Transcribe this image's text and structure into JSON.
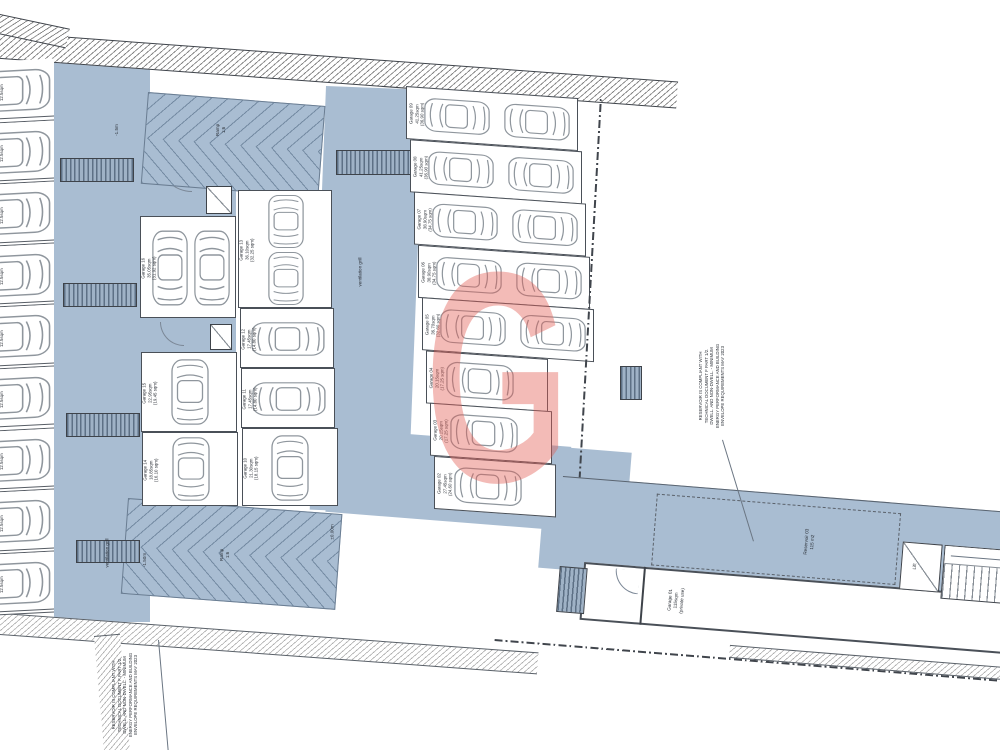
{
  "drawing": {
    "type": "basement garage floor plan"
  },
  "colors": {
    "floor_blue": "#a9bdd2",
    "watermark_red": "#e25e53",
    "wall_dark": "#3e434a"
  },
  "watermark": {
    "letter": "G"
  },
  "labels": {
    "ramp_top": "Ramp\n1:6",
    "ramp_bottom": "Ramp\n1:6",
    "level_top": "-1.5m",
    "level_bottom_left": "-1.50m",
    "level_bottom_right": "±0.00m",
    "vent_mid": "ventilation grill",
    "vent_bottom": "ventilation grill",
    "lift": "Lift",
    "reservoir": "Reservoir 03\n115 m2",
    "garage01": "Garage 01\n115sqm\n(private use)",
    "note_left": "RESERVOIR IS COMPLIANT WITH\nTECHNICAL DOCUMENT F PART 1/2.\nDWELL. AND NON-DWELL. - MINIMUM\nENERGY PERFORMANCE AND BUILDING\nENVELOPE REQUIREMENTS MAY 2023",
    "note_right": "RESERVOIR IS COMPLIANT WITH\nTECHNICAL DOCUMENT F PART 1/2.\nDWELL. AND NON-DWELL. - MINIMUM\nENERGY PERFORMANCE AND BUILDING\nENVELOPE REQUIREMENTS MAY 2023"
  },
  "left_stalls": [
    {
      "name": "Garage 17",
      "area": "12.5sqm"
    },
    {
      "name": "Garage 18",
      "area": "12.5sqm"
    },
    {
      "name": "Garage 19",
      "area": "12.5sqm"
    },
    {
      "name": "Garage 20",
      "area": "12.5sqm"
    },
    {
      "name": "Garage 21",
      "area": "12.5sqm"
    },
    {
      "name": "Garage 22",
      "area": "12.5sqm"
    },
    {
      "name": "Garage 23",
      "area": "12.5sqm"
    },
    {
      "name": "Garage 24",
      "area": "12.5sqm"
    },
    {
      "name": "Garage 25",
      "area": "12.5sqm"
    }
  ],
  "middle_garages": [
    {
      "name": "Garage 16",
      "area": "35.05sqm",
      "area2": "(31.92 sqm)",
      "cars": 2
    },
    {
      "name": "Garage 15",
      "area": "22.95sqm",
      "area2": "(19.45 sqm)",
      "cars": 1
    },
    {
      "name": "Garage 14",
      "area": "18.85sqm",
      "area2": "(16.10 sqm)",
      "cars": 1
    },
    {
      "name": "Garage 13",
      "area": "36.10sqm",
      "area2": "(32.25 sqm)",
      "cars": 2
    },
    {
      "name": "Garage 12",
      "area": "17.45sqm",
      "area2": "(14.80 sqm)",
      "cars": 1
    },
    {
      "name": "Garage 11",
      "area": "17.45sqm",
      "area2": "(14.80 sqm)",
      "cars": 1
    },
    {
      "name": "Garage 10",
      "area": "21.30sqm",
      "area2": "(18.15 sqm)",
      "cars": 1
    }
  ],
  "right_rows": [
    {
      "name": "Garage 09",
      "area": "41.25sqm",
      "area2": "(36.90 sqm)",
      "cars": 2
    },
    {
      "name": "Garage 08",
      "area": "41.25sqm",
      "area2": "(36.90 sqm)",
      "cars": 2
    },
    {
      "name": "Garage 07",
      "area": "38.90sqm",
      "area2": "(34.75 sqm)",
      "cars": 2
    },
    {
      "name": "Garage 06",
      "area": "38.90sqm",
      "area2": "(34.75 sqm)",
      "cars": 2
    },
    {
      "name": "Garage 05",
      "area": "36.70sqm",
      "area2": "(32.80 sqm)",
      "cars": 2
    },
    {
      "name": "Garage 04",
      "area": "20.15sqm",
      "area2": "(17.25 sqm)",
      "cars": 1
    },
    {
      "name": "Garage 03",
      "area": "20.15sqm",
      "area2": "(17.25 sqm)",
      "cars": 1
    },
    {
      "name": "Garage 02",
      "area": "27.45sqm",
      "area2": "(24.60 sqm)",
      "cars": 1
    }
  ]
}
